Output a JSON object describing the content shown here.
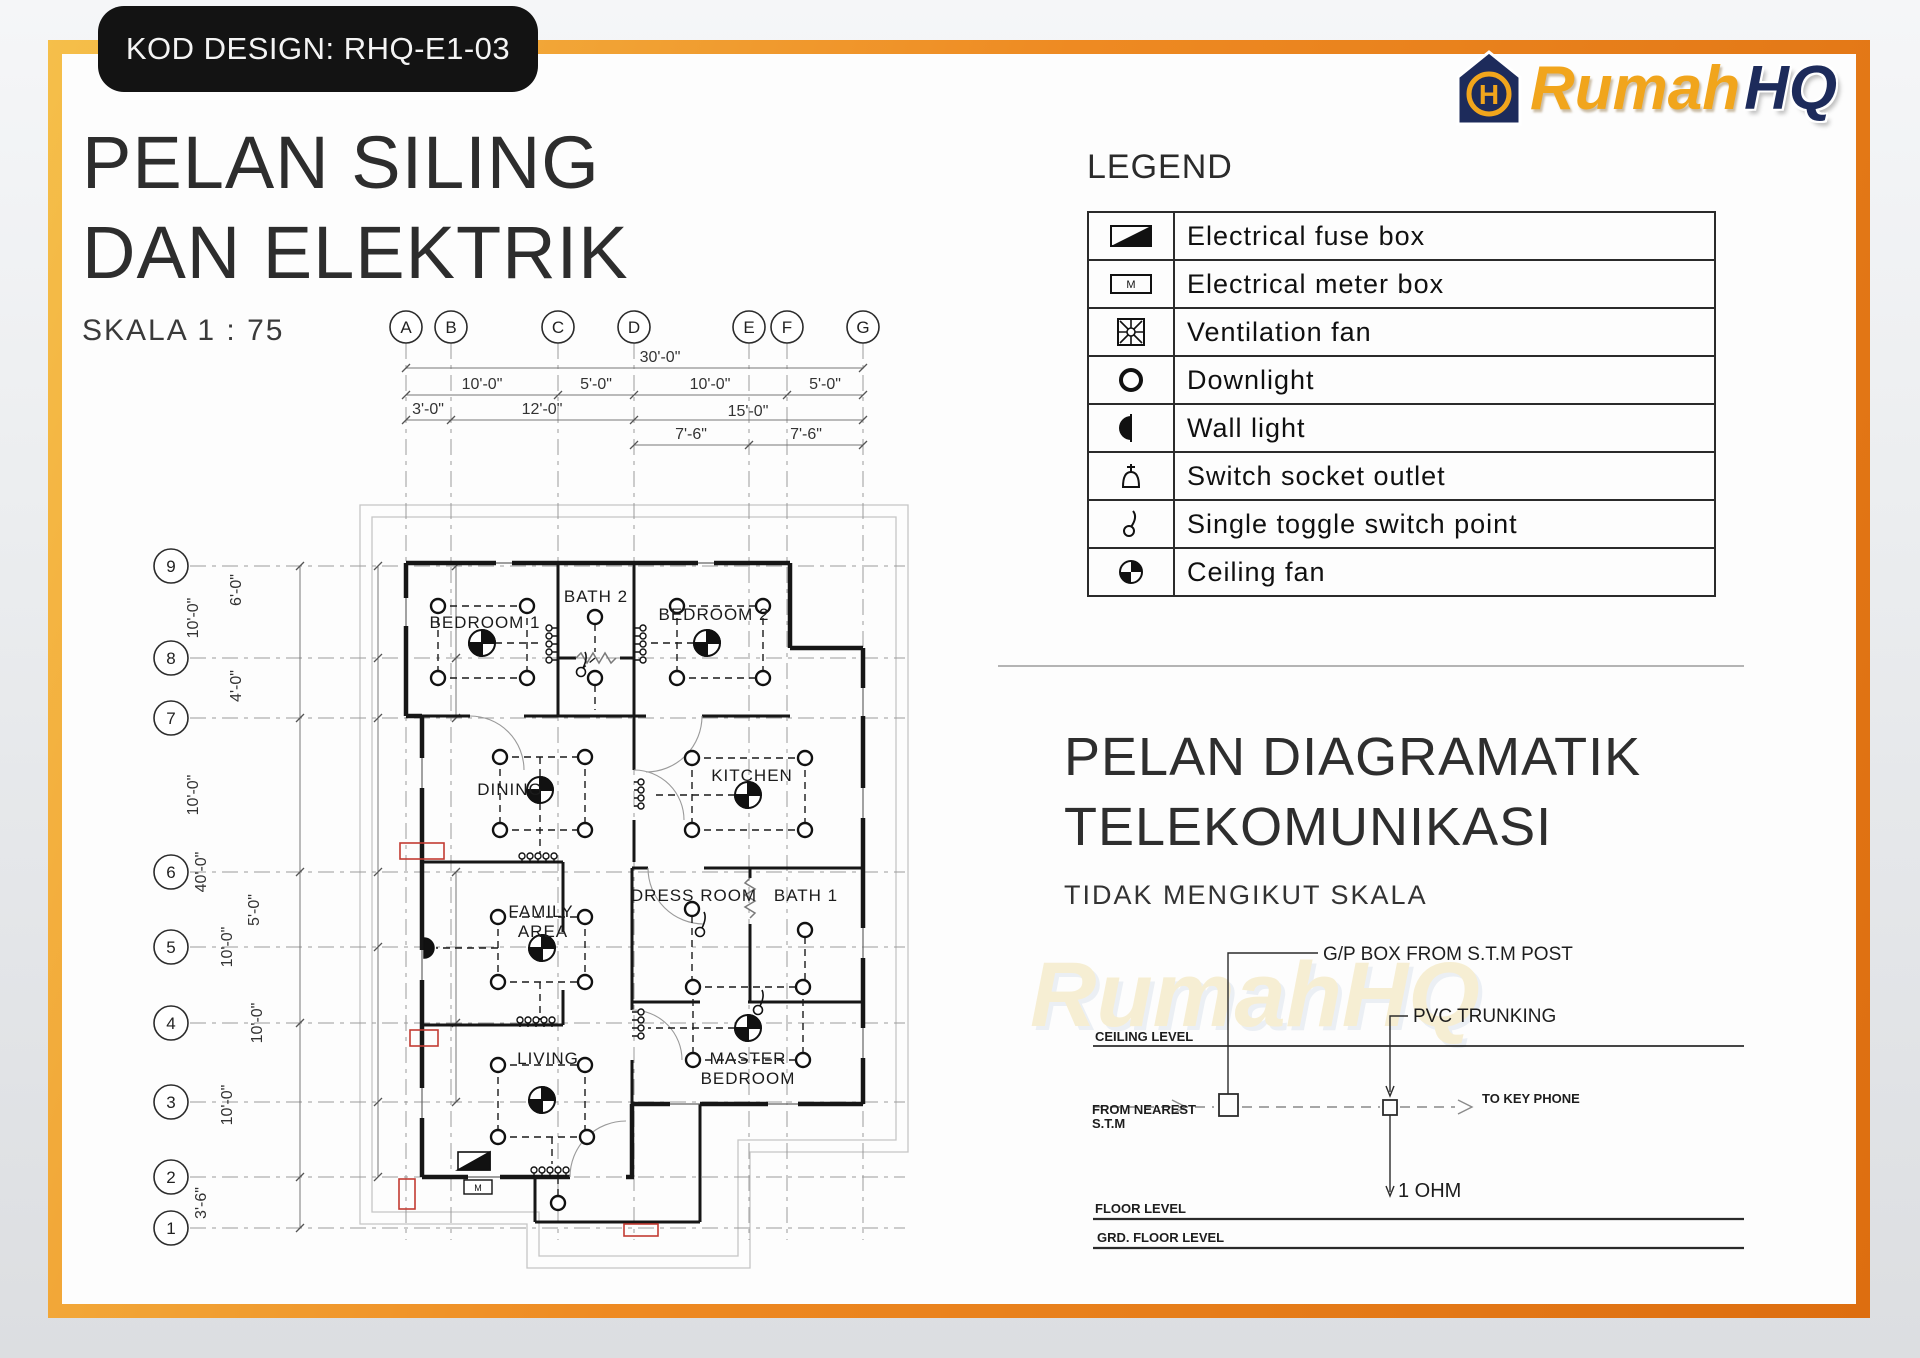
{
  "badge": {
    "label": "KOD DESIGN: RHQ-E1-03"
  },
  "titles": {
    "main_line1": "PELAN SILING",
    "main_line2": "DAN ELEKTRIK",
    "scale": "SKALA 1 : 75",
    "telecom_line1": "PELAN DIAGRAMATIK",
    "telecom_line2": "TELEKOMUNIKASI",
    "telecom_note": "TIDAK MENGIKUT SKALA"
  },
  "logo": {
    "brand_primary": "Rumah",
    "brand_secondary": "HQ",
    "monogram": "H",
    "gold": "#F1A51C",
    "navy": "#1D2B5B"
  },
  "watermark": {
    "text": "RumahHQ"
  },
  "colors": {
    "frame_orange": "#EE8A22",
    "accent_red": "#C23B33",
    "ink": "#161616"
  },
  "legend": {
    "title": "LEGEND",
    "meter_letter": "M",
    "items": [
      {
        "symbol": "electrical-fuse-box",
        "label": "Electrical  fuse  box"
      },
      {
        "symbol": "electrical-meter-box",
        "label": "Electrical  meter  box"
      },
      {
        "symbol": "ventilation-fan",
        "label": "Ventilation  fan"
      },
      {
        "symbol": "downlight",
        "label": "Downlight"
      },
      {
        "symbol": "wall-light",
        "label": "Wall  light"
      },
      {
        "symbol": "switch-socket-outlet",
        "label": "Switch  socket  outlet"
      },
      {
        "symbol": "single-toggle-switch",
        "label": "Single  toggle  switch  point"
      },
      {
        "symbol": "ceiling-fan",
        "label": "Ceiling  fan"
      }
    ]
  },
  "plan": {
    "grid_columns": [
      "A",
      "B",
      "C",
      "D",
      "E",
      "F",
      "G"
    ],
    "grid_rows": [
      "9",
      "8",
      "7",
      "6",
      "5",
      "4",
      "3",
      "2",
      "1"
    ],
    "dims_top": [
      "30'-0\"",
      "10'-0\"",
      "5'-0\"",
      "10'-0\"",
      "5'-0\"",
      "3'-0\"",
      "12'-0\"",
      "15'-0\"",
      "7'-6\"",
      "7'-6\""
    ],
    "dims_left": [
      "10'-0\"",
      "6'-0\"",
      "4'-0\"",
      "10'-0\"",
      "40'-0\"",
      "5'-0\"",
      "10'-0\"",
      "10'-0\"",
      "10'-0\"",
      "3'-6\""
    ],
    "rooms": [
      "BEDROOM 1",
      "BATH 2",
      "BEDROOM 2",
      "DINING",
      "KITCHEN",
      "FAMILY",
      "AREA",
      "DRESS ROOM",
      "BATH 1",
      "LIVING",
      "MASTER",
      "BEDROOM"
    ]
  },
  "telecom": {
    "gp_box": "G/P BOX FROM  S.T.M  POST",
    "pvc": "PVC TRUNKING",
    "ceiling": "CEILING  LEVEL",
    "from_line1": "FROM  NEAREST",
    "from_line2": "S.T.M",
    "to_key_phone": "TO  KEY  PHONE",
    "ohm": "1 OHM",
    "floor": "FLOOR  LEVEL",
    "grd_floor": "GRD.  FLOOR  LEVEL"
  }
}
